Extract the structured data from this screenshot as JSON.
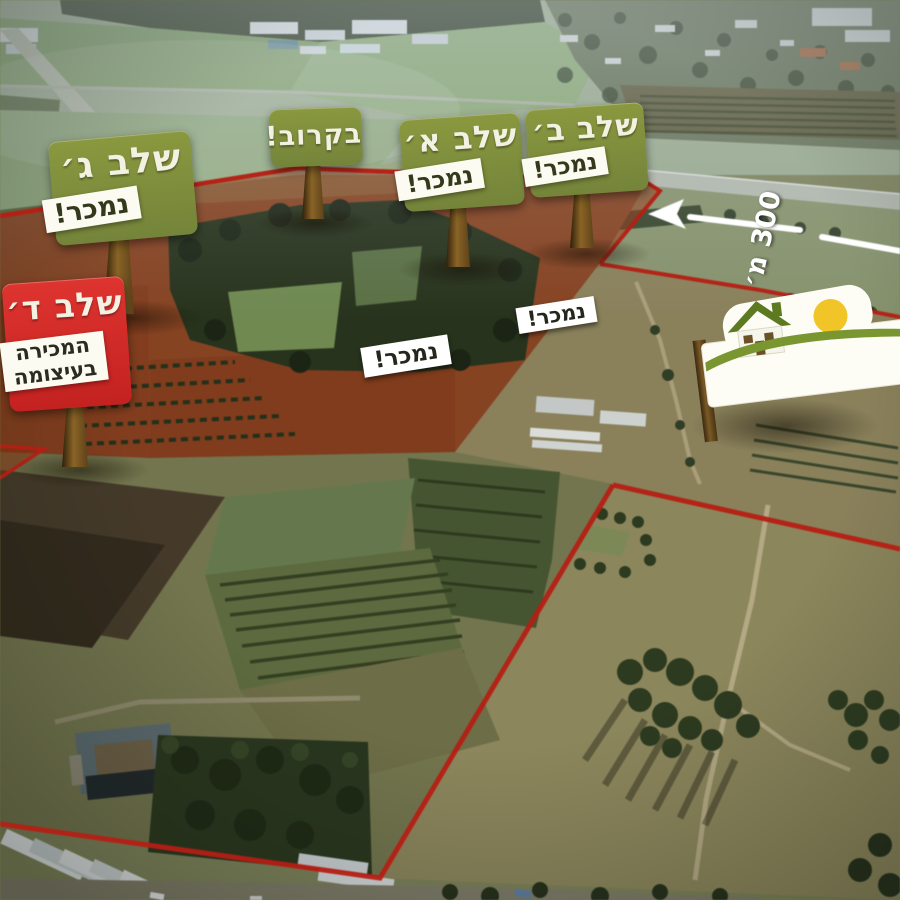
{
  "billboards": {
    "stage_c": {
      "title": "שלב ג׳",
      "status": "נמכר!"
    },
    "coming_soon": {
      "title": "בקרוב!"
    },
    "stage_a": {
      "title": "שלב א׳",
      "status": "נמכר!"
    },
    "stage_b": {
      "title": "שלב ב׳",
      "status": "נמכר!"
    },
    "stage_d": {
      "title": "שלב ד׳",
      "status_line1": "המכירה",
      "status_line2": "בעיצומה"
    }
  },
  "plot_markers": {
    "marker_left": "נמכר!",
    "marker_right": "נמכר!"
  },
  "distance_marker": {
    "label": "300 מ׳"
  },
  "logo": {
    "name": "מתחם שדות",
    "tagline": "בטוח בכרכור"
  },
  "colors": {
    "sign_green": "#7b8b3c",
    "sign_red": "#d2282a",
    "label_background": "#fcfbf1",
    "boundary_red": "#c01b10",
    "sold_overlay_red": "#9c2c06",
    "sun_yellow": "#f1c527",
    "logo_text_brown": "#5c4a28",
    "logo_green": "#7a9630",
    "arrow_white": "#ffffff"
  }
}
